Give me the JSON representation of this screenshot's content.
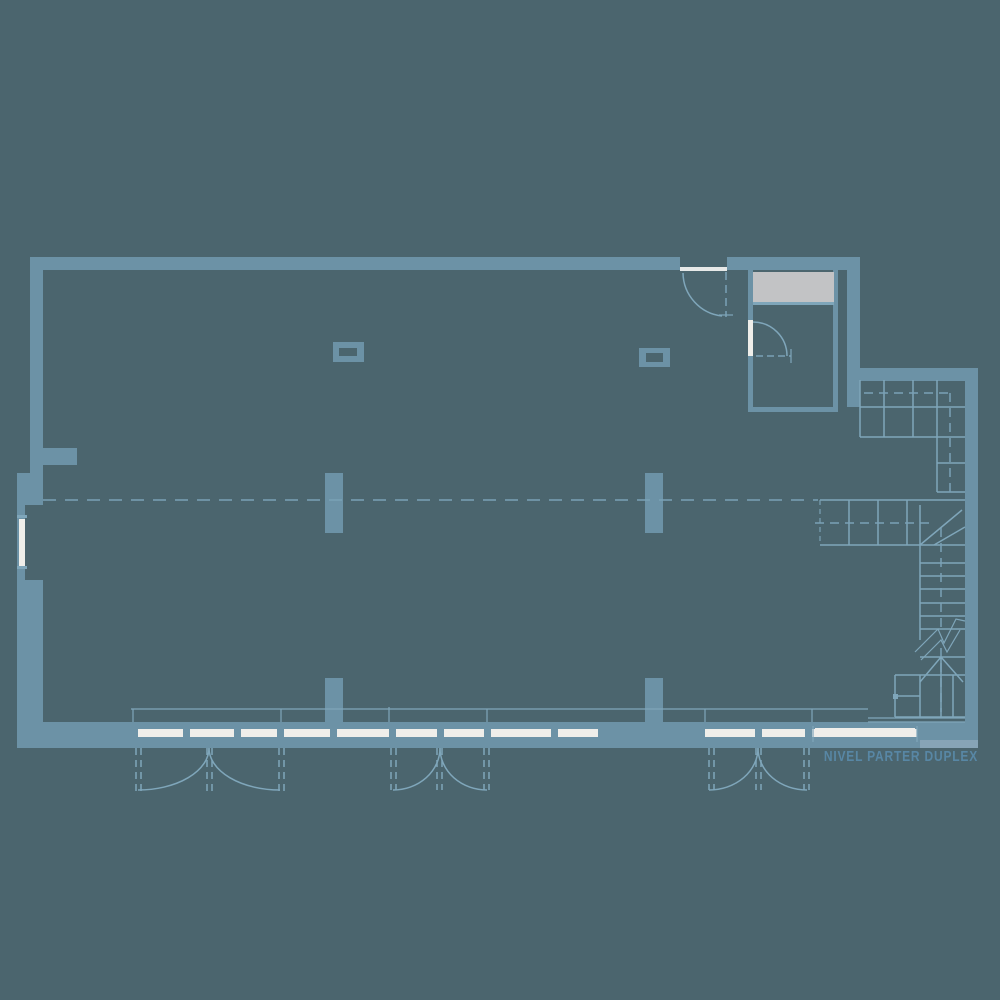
{
  "plan": {
    "level_label": "NIVEL PARTER DUPLEX"
  },
  "colors": {
    "bg": "#4b656e",
    "wall": "#6c92a6",
    "line": "#7fa6ba",
    "dash": "#7aa1b5",
    "glass": "#efeeea",
    "threshold": "#e7e9e8",
    "closet": "#c2c3c5",
    "step": "#87a4b6",
    "text": "#5887a5"
  }
}
